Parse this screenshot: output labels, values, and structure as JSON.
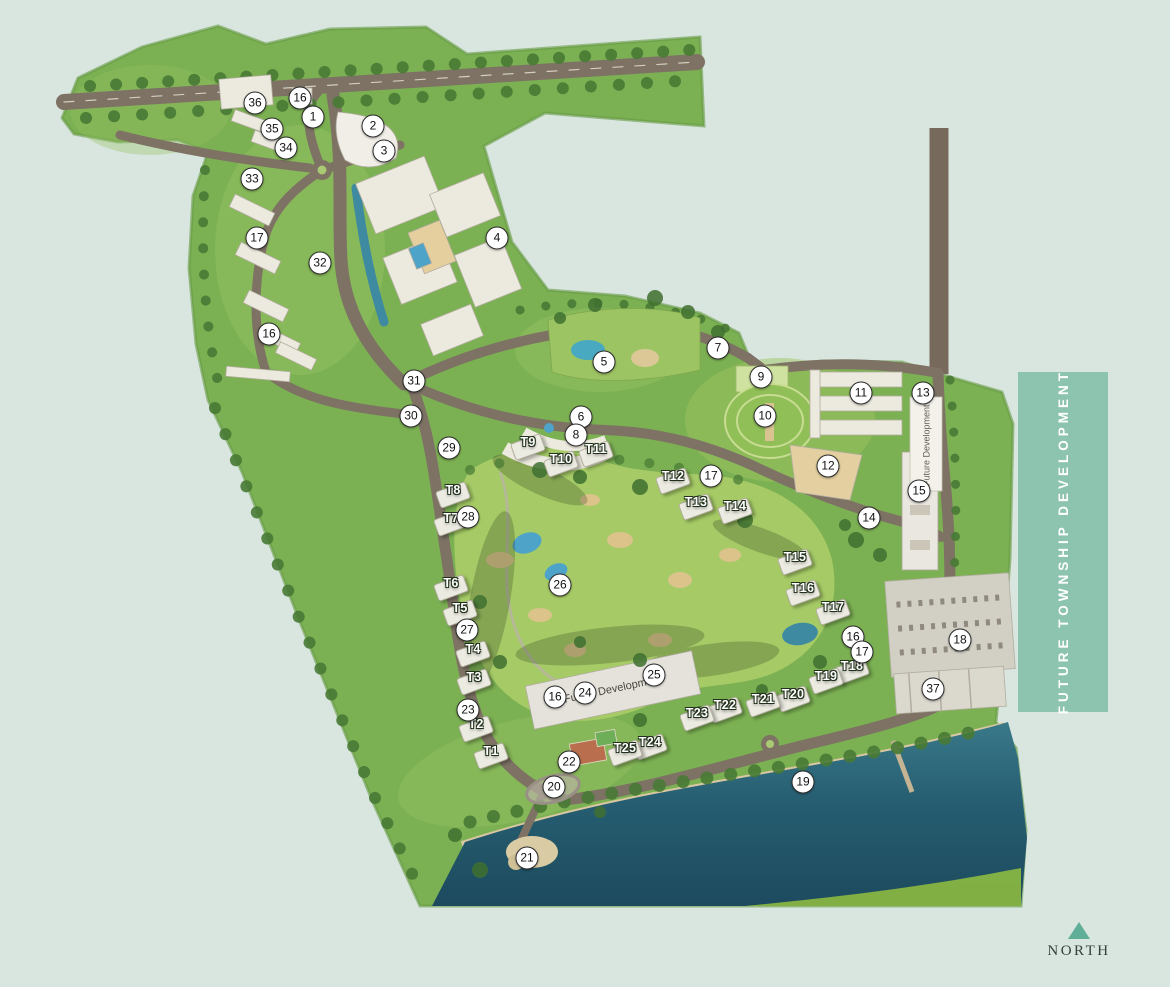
{
  "legend": {
    "banner_text": "FUTURE TOWNSHIP DEVELOPMENT",
    "north_label": "NORTH"
  },
  "labels": {
    "future_dev_building": "Future Development",
    "future_dev_slab": "Future Development"
  },
  "colors": {
    "background": "#d9e6df",
    "banner_teal": "#8cc4b0",
    "north_arrow_teal": "#5fae97",
    "land_green": "#7cb153",
    "golf_green": "#a6cb66",
    "water_dark": "#1d4a5e",
    "road_brown": "#7d7264",
    "sand": "#d8c7a0",
    "marker_fill": "#ffffff",
    "marker_border": "#2b2b2b"
  },
  "markers": [
    {
      "label": "1",
      "x": 313,
      "y": 117
    },
    {
      "label": "2",
      "x": 373,
      "y": 126
    },
    {
      "label": "3",
      "x": 384,
      "y": 151
    },
    {
      "label": "4",
      "x": 497,
      "y": 238
    },
    {
      "label": "5",
      "x": 604,
      "y": 362
    },
    {
      "label": "6",
      "x": 581,
      "y": 417
    },
    {
      "label": "7",
      "x": 718,
      "y": 348
    },
    {
      "label": "8",
      "x": 576,
      "y": 435
    },
    {
      "label": "9",
      "x": 761,
      "y": 377
    },
    {
      "label": "10",
      "x": 765,
      "y": 416
    },
    {
      "label": "11",
      "x": 861,
      "y": 393
    },
    {
      "label": "12",
      "x": 828,
      "y": 466
    },
    {
      "label": "13",
      "x": 923,
      "y": 393
    },
    {
      "label": "14",
      "x": 869,
      "y": 518
    },
    {
      "label": "15",
      "x": 919,
      "y": 491
    },
    {
      "label": "16",
      "x": 300,
      "y": 98
    },
    {
      "label": "16",
      "x": 269,
      "y": 334
    },
    {
      "label": "16",
      "x": 555,
      "y": 697
    },
    {
      "label": "16",
      "x": 853,
      "y": 637
    },
    {
      "label": "17",
      "x": 257,
      "y": 238
    },
    {
      "label": "17",
      "x": 711,
      "y": 476
    },
    {
      "label": "17",
      "x": 862,
      "y": 652
    },
    {
      "label": "18",
      "x": 960,
      "y": 640
    },
    {
      "label": "19",
      "x": 803,
      "y": 782
    },
    {
      "label": "20",
      "x": 554,
      "y": 787
    },
    {
      "label": "21",
      "x": 527,
      "y": 858
    },
    {
      "label": "22",
      "x": 569,
      "y": 762
    },
    {
      "label": "23",
      "x": 468,
      "y": 710
    },
    {
      "label": "24",
      "x": 585,
      "y": 693
    },
    {
      "label": "25",
      "x": 654,
      "y": 675
    },
    {
      "label": "26",
      "x": 560,
      "y": 585
    },
    {
      "label": "27",
      "x": 467,
      "y": 630
    },
    {
      "label": "28",
      "x": 468,
      "y": 517
    },
    {
      "label": "29",
      "x": 449,
      "y": 448
    },
    {
      "label": "30",
      "x": 411,
      "y": 416
    },
    {
      "label": "31",
      "x": 414,
      "y": 381
    },
    {
      "label": "32",
      "x": 320,
      "y": 263
    },
    {
      "label": "33",
      "x": 252,
      "y": 179
    },
    {
      "label": "34",
      "x": 286,
      "y": 148
    },
    {
      "label": "35",
      "x": 272,
      "y": 129
    },
    {
      "label": "36",
      "x": 255,
      "y": 103
    },
    {
      "label": "37",
      "x": 933,
      "y": 689
    }
  ],
  "towers": [
    {
      "label": "T1",
      "x": 491,
      "y": 751
    },
    {
      "label": "T2",
      "x": 476,
      "y": 724
    },
    {
      "label": "T3",
      "x": 474,
      "y": 677
    },
    {
      "label": "T4",
      "x": 473,
      "y": 649
    },
    {
      "label": "T5",
      "x": 460,
      "y": 608
    },
    {
      "label": "T6",
      "x": 451,
      "y": 583
    },
    {
      "label": "T7",
      "x": 451,
      "y": 518
    },
    {
      "label": "T8",
      "x": 453,
      "y": 490
    },
    {
      "label": "T9",
      "x": 528,
      "y": 442
    },
    {
      "label": "T10",
      "x": 561,
      "y": 459
    },
    {
      "label": "T11",
      "x": 596,
      "y": 449
    },
    {
      "label": "T12",
      "x": 673,
      "y": 476
    },
    {
      "label": "T13",
      "x": 696,
      "y": 502
    },
    {
      "label": "T14",
      "x": 735,
      "y": 506
    },
    {
      "label": "T15",
      "x": 795,
      "y": 557
    },
    {
      "label": "T16",
      "x": 803,
      "y": 588
    },
    {
      "label": "T17",
      "x": 833,
      "y": 607
    },
    {
      "label": "T18",
      "x": 852,
      "y": 666
    },
    {
      "label": "T19",
      "x": 826,
      "y": 676
    },
    {
      "label": "T20",
      "x": 793,
      "y": 694
    },
    {
      "label": "T21",
      "x": 763,
      "y": 699
    },
    {
      "label": "T22",
      "x": 725,
      "y": 705
    },
    {
      "label": "T23",
      "x": 697,
      "y": 713
    },
    {
      "label": "T24",
      "x": 650,
      "y": 742
    },
    {
      "label": "T25",
      "x": 625,
      "y": 748
    }
  ]
}
